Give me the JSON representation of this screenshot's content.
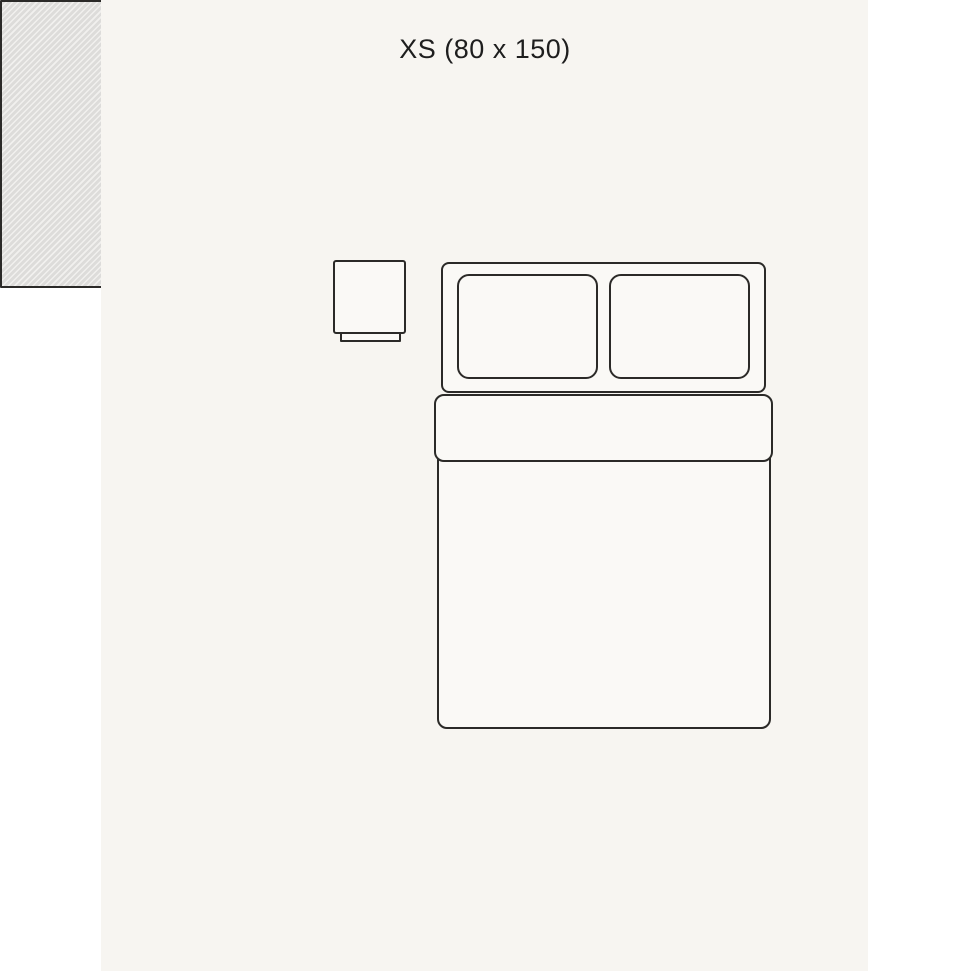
{
  "title": {
    "label": "XS (80 x 150)"
  },
  "colors": {
    "page_bg": "#ffffff",
    "panel_bg": "#f7f5f1",
    "ink": "#2b2a28",
    "fill": "#faf9f6",
    "hatch_dark": "#dddcda",
    "hatch_light": "#f1f0ee",
    "text": "#1e1e1e"
  },
  "diagram": {
    "type": "rug-size-guide",
    "rug": {
      "pattern": "diagonal-hatch",
      "placement": "beside-bed-left"
    },
    "bed": {
      "parts": [
        "headboard",
        "pillow-left",
        "pillow-right",
        "duvet-fold",
        "duvet-body"
      ]
    },
    "nightstand": {
      "parts": [
        "top",
        "base"
      ]
    }
  }
}
